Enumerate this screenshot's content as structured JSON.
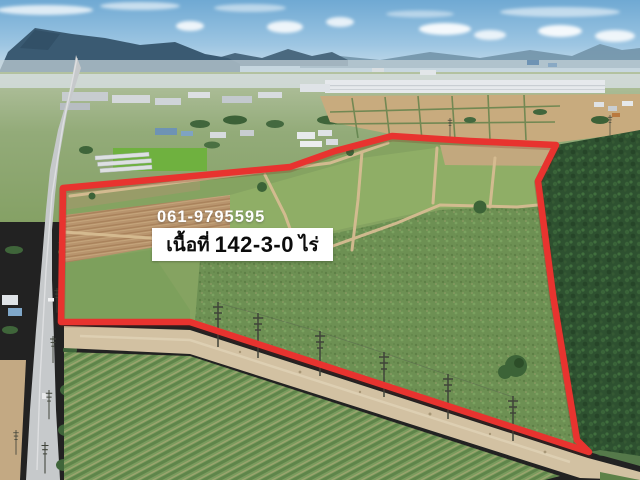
{
  "overlay": {
    "phone_number": "061-9795595",
    "area_label": {
      "prefix": "เนื้อที่",
      "value": "142-3-0",
      "unit": "ไร่",
      "full_text": "เนื้อที่ 142-3-0 ไร่"
    }
  },
  "annotation": {
    "boundary_color": "#e8332f",
    "label_background": "#ffffff",
    "label_text_color": "#0c0c0c",
    "phone_text_color": "#ffffff"
  },
  "scene": {
    "description": "aerial drone photo of a farmland plot for sale, outlined with a red boundary; paved road on the left, industrial estate and mountains on the horizon, dense forest on the right, dirt track with power poles along the lower boundary",
    "colors": {
      "sky": "#7ab2d8",
      "mountains": "#3a5a72",
      "distant_hills": "#7293a8",
      "field_green": "#85a361",
      "plowed_soil": "#b8946d",
      "forest": "#2e5130",
      "paved_road": "#c6c9cb",
      "dirt_track": "#d2c1a2"
    }
  }
}
